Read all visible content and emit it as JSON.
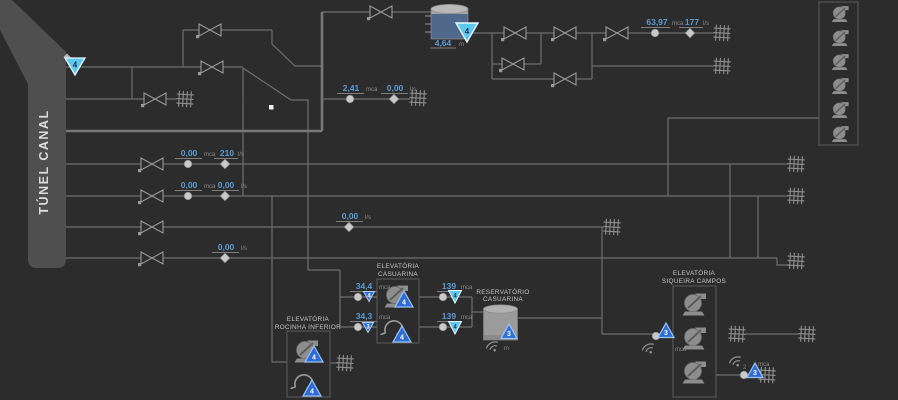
{
  "title": "TÚNEL CANAL",
  "colors": {
    "background": "#2c2c2c",
    "pipe": "#6e6e6e",
    "band": "#4f4f4f",
    "value_blue": "#5b9bd5",
    "unit_gray": "#8a8a8a",
    "cyan_indicator": "#5ec9ef",
    "blue_indicator": "#2f6fd8",
    "pump_gray": "#8d8d8d"
  },
  "main_tank": {
    "value": "4,64",
    "unit": "m",
    "level_badge": "4"
  },
  "tunnel_marker": {
    "digit": "4"
  },
  "sensors": [
    {
      "value": "2,41",
      "unit": "mca"
    },
    {
      "value": "0,00",
      "unit": "l/s"
    },
    {
      "value": "63,97",
      "unit": "mca"
    },
    {
      "value": "177",
      "unit": "l/s"
    },
    {
      "value": "0,00",
      "unit": "mca"
    },
    {
      "value": "210",
      "unit": "l/s"
    },
    {
      "value": "0,00",
      "unit": "mca"
    },
    {
      "value": "0,00",
      "unit": "l/s"
    },
    {
      "value": "0,00",
      "unit": "l/s"
    },
    {
      "value": "0,00",
      "unit": "l/s"
    },
    {
      "value": "34,4",
      "unit": "mca",
      "badge": "4"
    },
    {
      "value": "34,3",
      "unit": "mca",
      "badge": "3"
    },
    {
      "value": "139",
      "unit": "mca",
      "badge": "4"
    },
    {
      "value": "139",
      "unit": "mca",
      "badge": "4"
    }
  ],
  "stations": {
    "casuarina": {
      "line1": "ELEVATÓRIA",
      "line2": "CASUARINA",
      "pump_badge1": "4",
      "pump_badge2": "4"
    },
    "rocinha": {
      "line1": "ELEVATÓRIA",
      "line2": "ROCINHA INFERIOR",
      "pump_badge1": "4",
      "pump_badge2": "4"
    },
    "siqueira": {
      "line1": "ELEVATÓRIA",
      "line2": "SIQUEIRA CAMPOS",
      "inlet_badge": "3",
      "inlet_unit": "mca",
      "outlet_badge": "3",
      "outlet_unit": "mca",
      "outlet_signal": "2"
    },
    "reservatorio": {
      "line1": "RESERVATÓRIO",
      "line2": "CASUARINA",
      "badge": "3",
      "unit": "m"
    }
  }
}
